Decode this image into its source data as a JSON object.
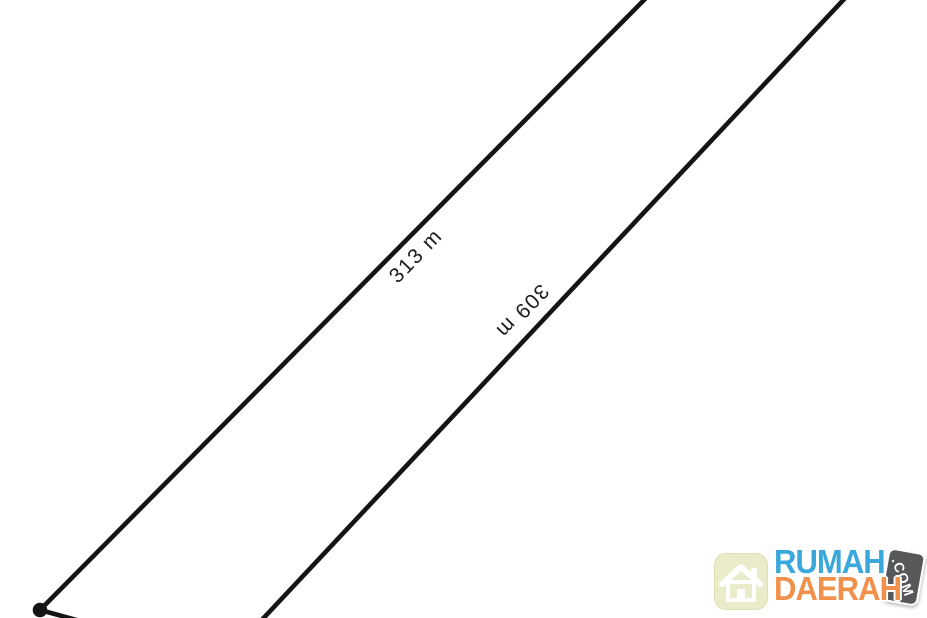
{
  "diagram": {
    "type": "land-plot-boundary-sketch",
    "background": "#ffffff",
    "line_color": "#141414",
    "labels": {
      "side1": "313 m",
      "side2": "309 m"
    }
  },
  "watermark": {
    "brand_line1": "RUMAH",
    "brand_line2": "DAERAH",
    "badge": ".COM",
    "icon": "house-icon",
    "colors": {
      "brand_line1": "#3BA8DB",
      "brand_line2": "#F0914B",
      "badge_bg": "#57585A",
      "badge_text": "#FFFFFF",
      "icon_bg": "#EAEBC9"
    }
  }
}
